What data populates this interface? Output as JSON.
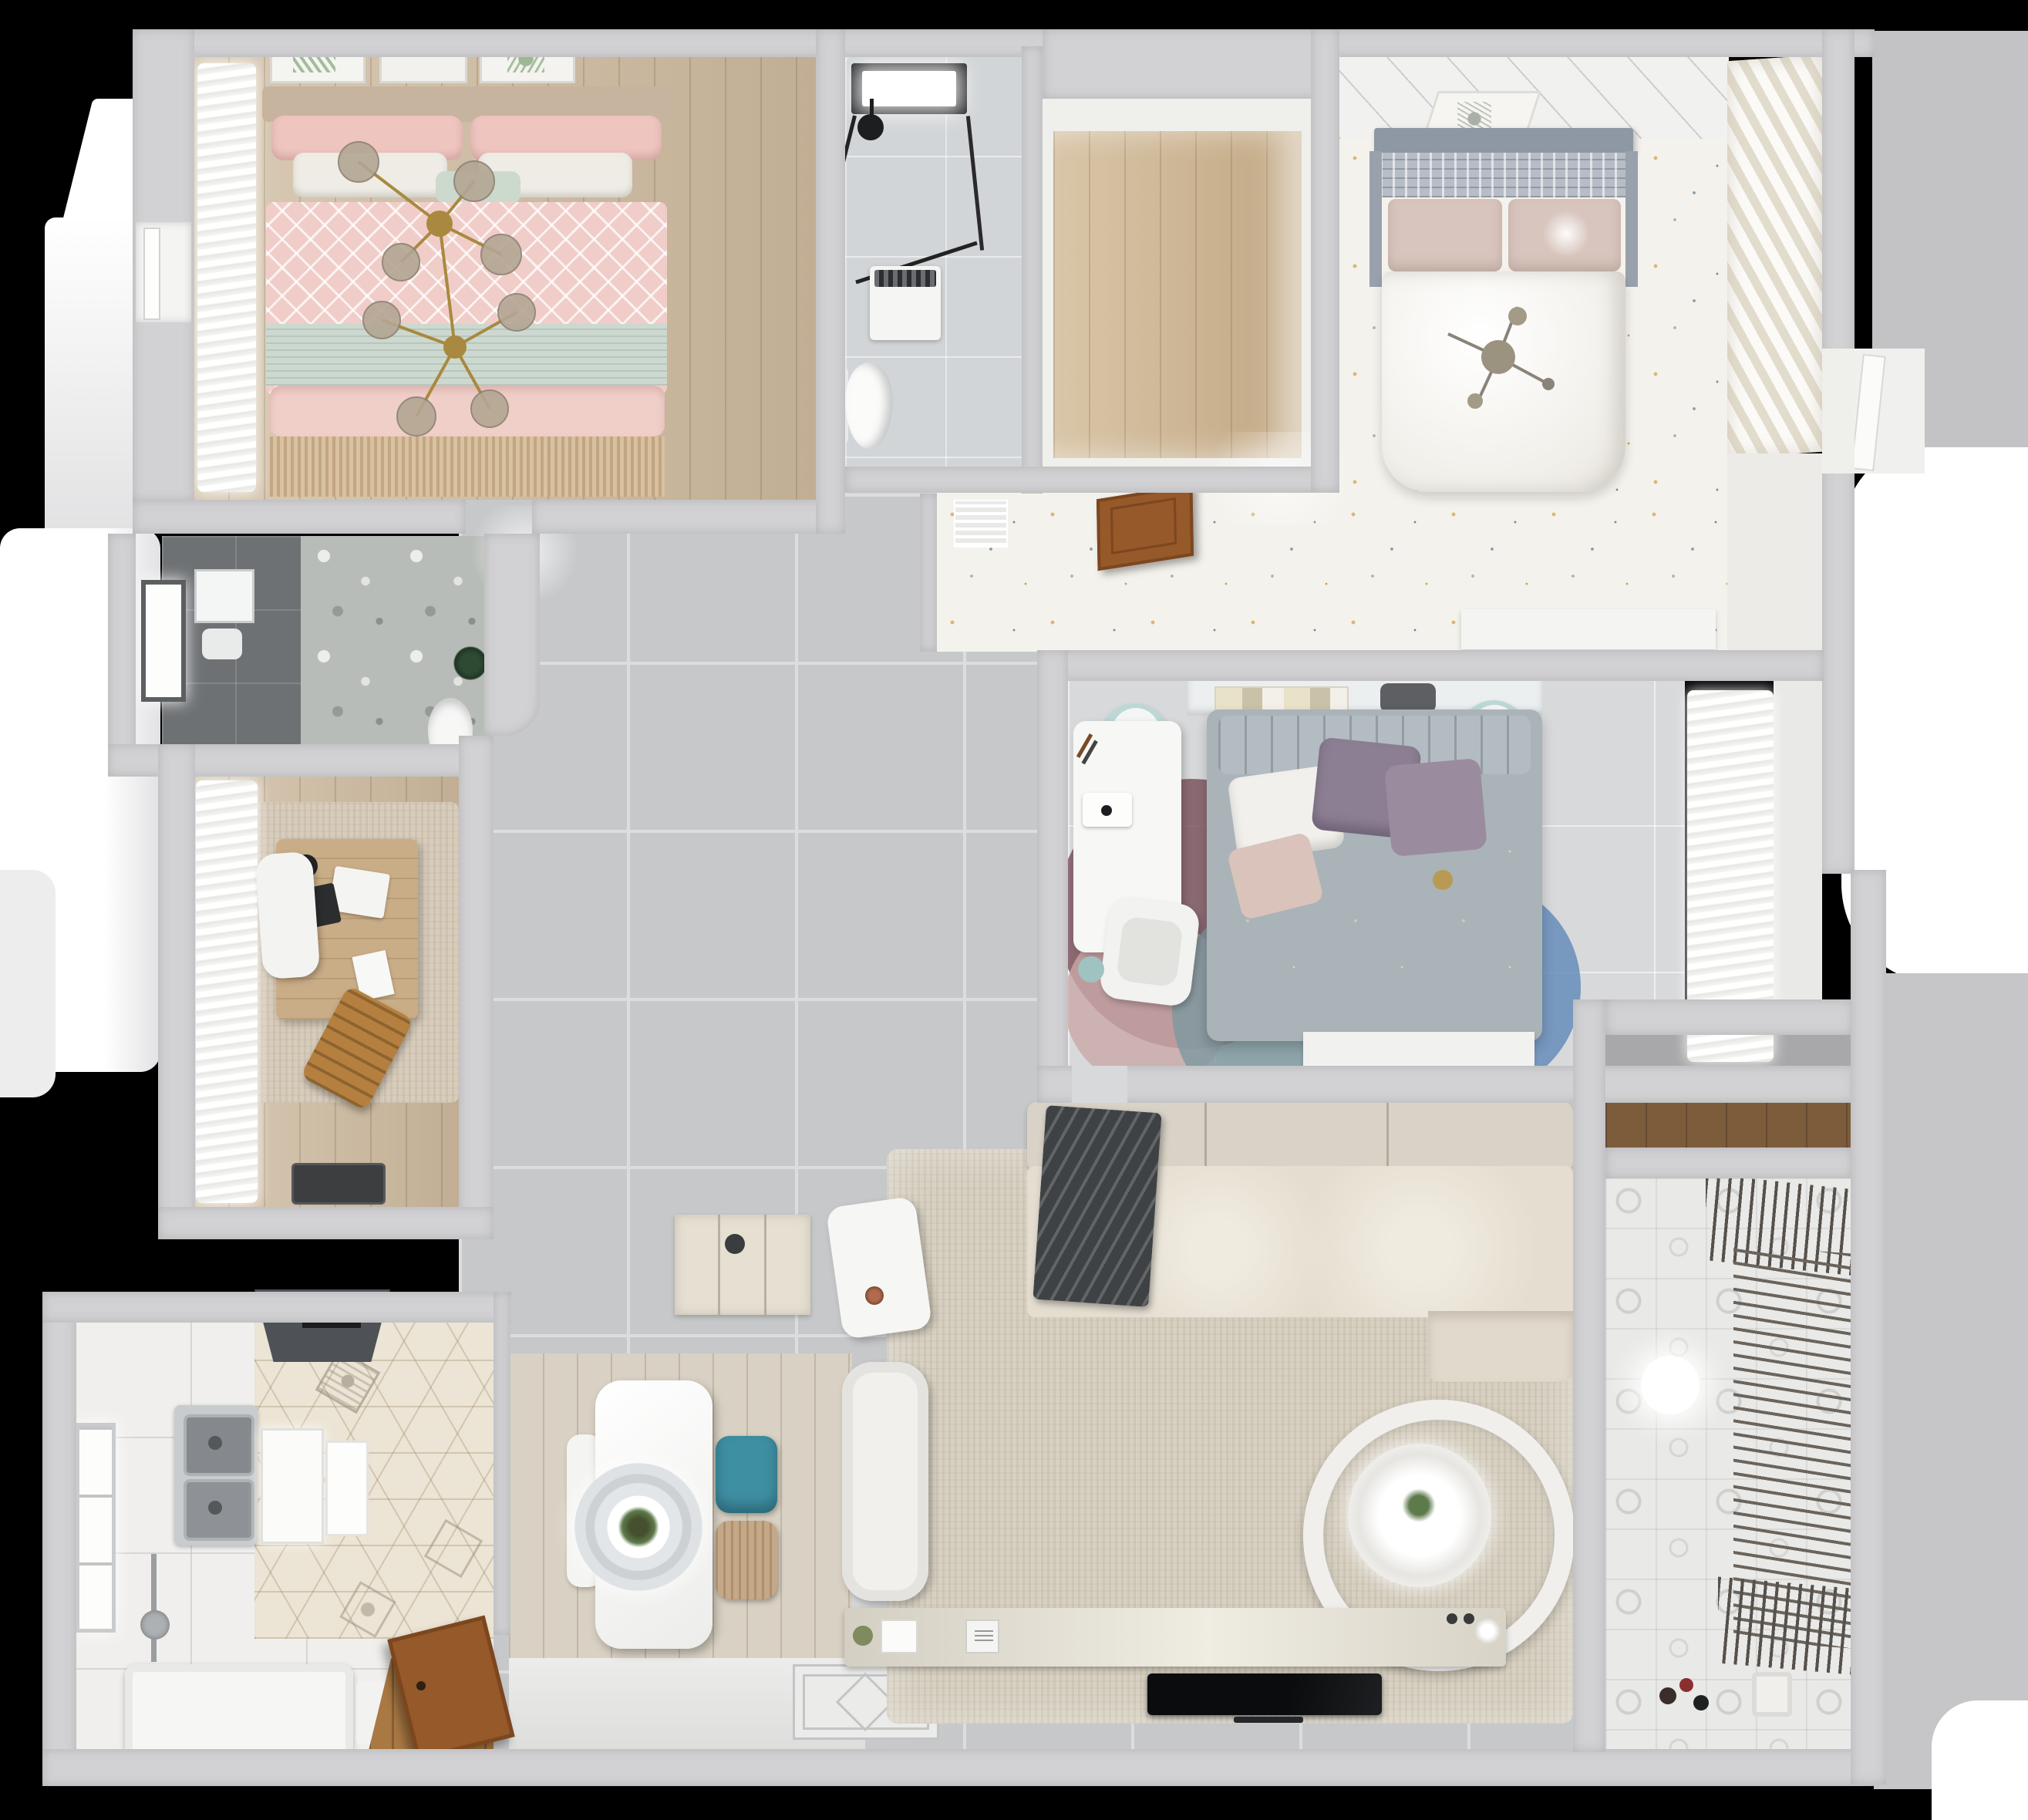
{
  "meta": {
    "title": "Top-down 3D render of a furnished apartment floor plan",
    "view": "bird's-eye dollhouse render",
    "background_color": "#000000"
  },
  "palette": {
    "wall": "#d2d2d4",
    "hall_tile": "#c6c8ca",
    "grout": "#dcdddf",
    "wood_tan": "#cdb99d",
    "speckle_floor": "#f4f2ec",
    "marble": "#d2d5d7",
    "pink_bedding": "#f0cbc6",
    "mint_band": "#cdd9d0",
    "sofa_cream": "#e2dccf",
    "rug_beige": "#d8d1c2",
    "teal_chair": "#3f8fa2",
    "charcoal_throw": "#3f4245",
    "door_brown": "#95592a",
    "shelf_wood": "#7d5c3c",
    "canopy_gray": "#9aa2ad",
    "purple_pillow": "#8d7f93",
    "rug_maroon": "#7e5560",
    "rug_teal": "#7e98a0",
    "rug_blue": "#5f87b8",
    "gold_chandelier": "#a8893f",
    "plant_green": "#5d7a4b"
  },
  "rooms": [
    {
      "id": "bedroom-pink",
      "label": "Bedroom with pink bedding (top-left)",
      "floor": "tan wood",
      "items": [
        "double bed with pink duvet and mint runner",
        "gold branch chandelier",
        "gray window curtains",
        "botanical wall art frames"
      ]
    },
    {
      "id": "bathroom-main",
      "label": "Bathroom (top-middle)",
      "floor": "light marble tile",
      "items": [
        "skylight",
        "glass shower with black frame",
        "washing machine",
        "toilet",
        "black shower fixture"
      ]
    },
    {
      "id": "closet-room",
      "label": "Walk-in closet / pantry with wood floor",
      "floor": "light oak",
      "items": []
    },
    {
      "id": "bedroom-master",
      "label": "Master bedroom (top-right)",
      "floor": "white terrazzo speckle",
      "items": [
        "bed with gray slatted canopy",
        "white duvet",
        "stick ceiling lamp",
        "slatted wardrobe",
        "art frame",
        "white sideboard with plant"
      ]
    },
    {
      "id": "corridor",
      "label": "Corridor with speckled floor",
      "floor": "white terrazzo speckle",
      "items": [
        "AC vent grille",
        "open wooden door",
        "potted plant on sill"
      ]
    },
    {
      "id": "bedroom-center",
      "label": "Center bedroom / study bedroom",
      "floor": "pale gray tile",
      "items": [
        "bed with gray frame, purple pillows",
        "desk with computer",
        "white desk chair",
        "two mint stools",
        "book shelf",
        "multicolor round rugs",
        "sheer curtains"
      ]
    },
    {
      "id": "bathroom-small",
      "label": "Small dark bathroom (mid-left)",
      "floor": "dark gray tile",
      "items": [
        "window",
        "mirror",
        "toilet",
        "floral accent wall",
        "plant"
      ]
    },
    {
      "id": "study",
      "label": "Study (mid-left)",
      "floor": "tan wood with beige rug",
      "items": [
        "wooden desk with laptop",
        "white chair",
        "dark gray round rug",
        "wooden side chair",
        "white curtains",
        "dark floor mat"
      ]
    },
    {
      "id": "kitchen",
      "label": "Kitchen (bottom-left)",
      "floor": "white tile + hexagon tile",
      "items": [
        "range hood",
        "double stainless sink",
        "window",
        "white counter/tub",
        "open brown door",
        "white cabinets"
      ]
    },
    {
      "id": "dining",
      "label": "Dining nook",
      "floor": "light wood planks",
      "items": [
        "white dining table with ring pendant and plant",
        "teal chair",
        "wicker chair",
        "white chair",
        "cream sideboard",
        "ornate entry mat"
      ]
    },
    {
      "id": "living",
      "label": "Living room",
      "floor": "gray tile with large beige rug",
      "items": [
        "cream sectional sofa",
        "charcoal throw",
        "white armchair",
        "white cube side table",
        "round double-ring coffee table with plant",
        "TV console with decor",
        "flat black TV"
      ]
    },
    {
      "id": "balcony",
      "label": "Balcony / laundry (bottom-right)",
      "floor": "patterned tile",
      "items": [
        "clothes drying rack",
        "ceiling light",
        "toys",
        "storage niche with wood shelf"
      ]
    }
  ]
}
